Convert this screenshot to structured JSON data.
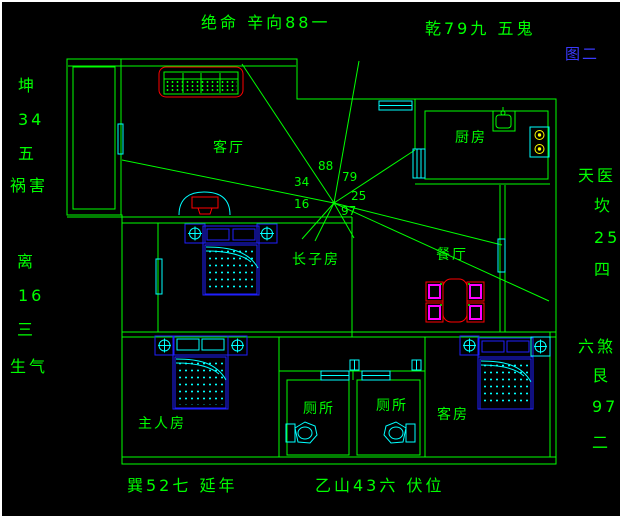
{
  "figure_label": "图二",
  "compass": {
    "top_left_caption": "绝命 辛向88一",
    "top_right_caption": "乾79九 五鬼",
    "left_upper": [
      "坤",
      "34",
      "五",
      "祸害"
    ],
    "left_lower": [
      "离",
      "16",
      "三",
      "生气"
    ],
    "right_upper": [
      "天医",
      "坎",
      "25",
      "四"
    ],
    "right_lower": [
      "六煞",
      "艮",
      "97",
      "二"
    ],
    "bottom_left_caption": "巽52七 延年",
    "bottom_right_caption": "乙山43六 伏位"
  },
  "rooms": {
    "living_room": "客厅",
    "kitchen": "厨房",
    "eldest_son_room": "长子房",
    "dining_room": "餐厅",
    "master_bedroom": "主人房",
    "toilet_left": "厕所",
    "toilet_right": "厕所",
    "guest_room": "客房"
  },
  "center_numbers": {
    "n88": "88",
    "n79": "79",
    "n34": "34",
    "n25": "25",
    "n16": "16",
    "n97": "97"
  },
  "colors": {
    "background": "#000000",
    "wall_green": "#00ff00",
    "furniture_red": "#ff0000",
    "fixture_cyan": "#00ffff",
    "bed_blue": "#1f1fff",
    "chair_magenta": "#ff00ff",
    "burner_yellow": "#ffff00",
    "figure_label_blue": "#3a3aff"
  }
}
